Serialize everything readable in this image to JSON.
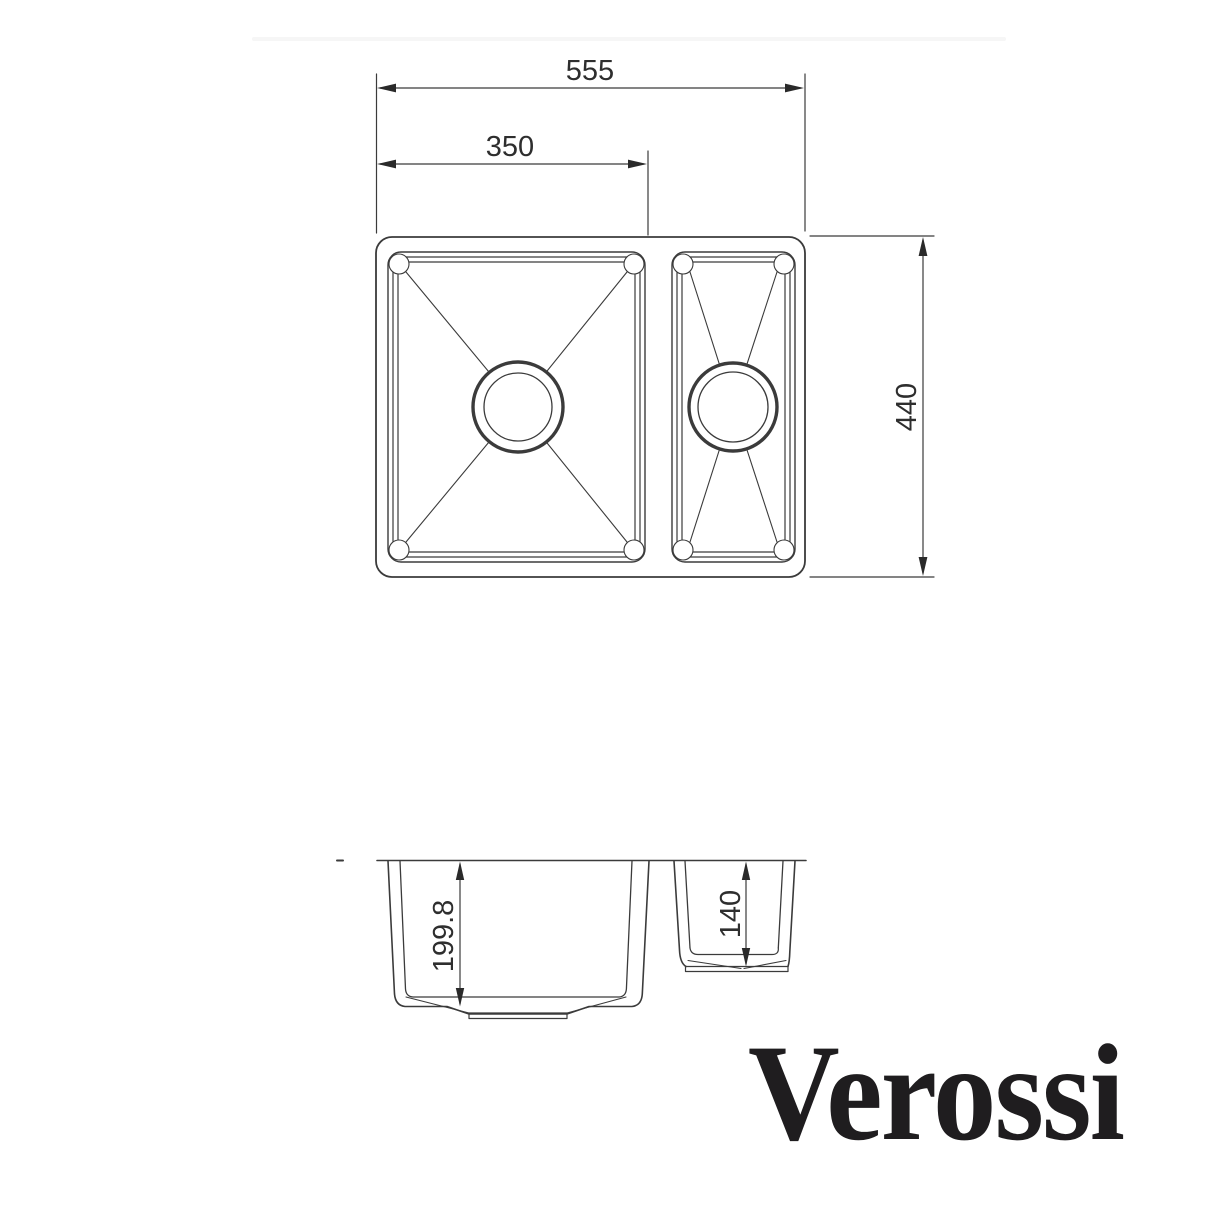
{
  "page": {
    "background": "#ffffff",
    "divider_color": "#f6f6f6"
  },
  "drawing": {
    "line_color": "#3b3b3b",
    "dim_text_color": "#2e2e2e",
    "dimensions": {
      "overall_width": "555",
      "main_bowl_width": "350",
      "overall_depth": "440",
      "main_bowl_depth": "199.8",
      "half_bowl_depth": "140"
    }
  },
  "brand": {
    "name": "Verossi",
    "color": "#1f1d1f"
  }
}
